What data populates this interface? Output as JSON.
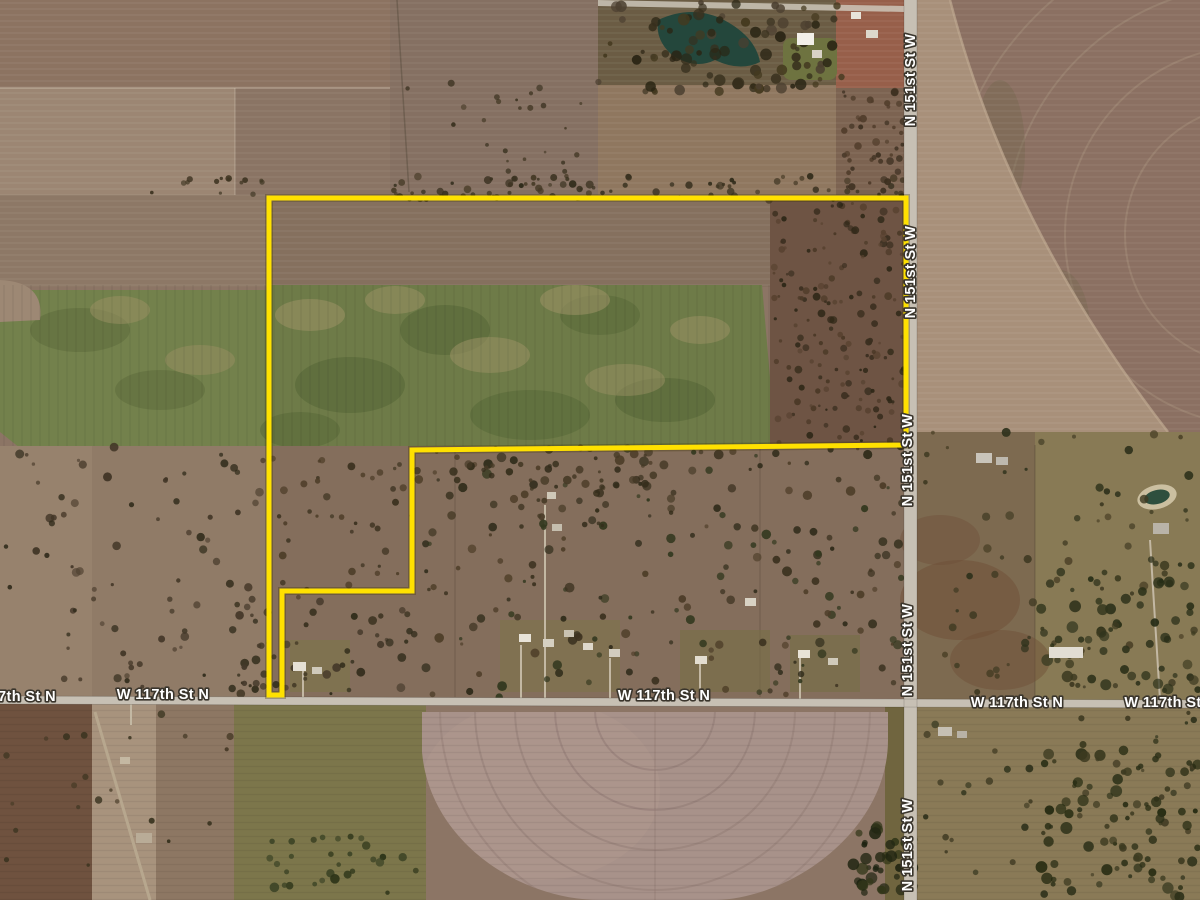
{
  "map": {
    "type": "satellite-imagery",
    "roads": {
      "vertical_road": {
        "name": "N 151st St W",
        "labels": [
          {
            "text": "N 151st St W",
            "x": 915,
            "y": 80,
            "rotate": -90
          },
          {
            "text": "N 151st St W",
            "x": 915,
            "y": 272,
            "rotate": -90
          },
          {
            "text": "N 151st St W",
            "x": 912,
            "y": 460,
            "rotate": -90
          },
          {
            "text": "N 151st St W",
            "x": 912,
            "y": 650,
            "rotate": -90
          },
          {
            "text": "N 151st St W",
            "x": 912,
            "y": 845,
            "rotate": -90
          }
        ]
      },
      "horizontal_road": {
        "name": "W 117th St N",
        "labels": [
          {
            "text": "7th St N",
            "x": 27,
            "y": 701,
            "rotate": 0
          },
          {
            "text": "W 117th St N",
            "x": 163,
            "y": 699,
            "rotate": 0
          },
          {
            "text": "W 117th St N",
            "x": 664,
            "y": 700,
            "rotate": 0
          },
          {
            "text": "W 117th St N",
            "x": 1017,
            "y": 707,
            "rotate": 0
          },
          {
            "text": "W 117th St",
            "x": 1163,
            "y": 707,
            "rotate": 0
          }
        ]
      }
    },
    "parcel": {
      "outline_color": "#ffe100",
      "vertices": "271,198 906,198 906,445 412,450 412,591 282,591 282,695 269,695 269,198"
    },
    "label_style": {
      "fill": "#ffffff",
      "halo": "#3a352c"
    },
    "road_color": "#c7c0b4"
  }
}
